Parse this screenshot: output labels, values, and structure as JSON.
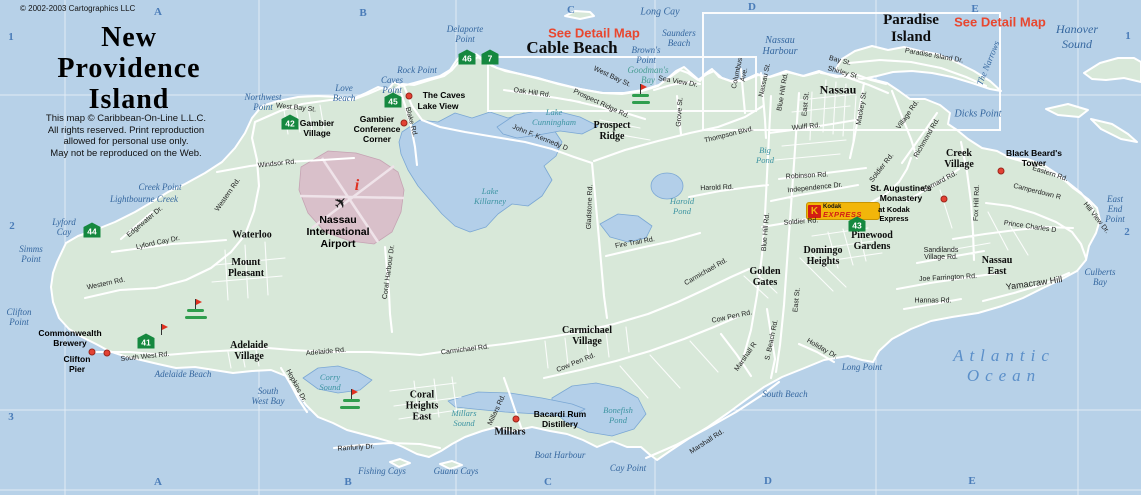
{
  "header": {
    "copyright": "© 2002-2003 Cartographics LLC",
    "title": "New\nProvidence\nIsland",
    "disclaimer": "This map © Caribbean-On-Line L.L.C.\nAll rights reserved. Print reproduction\nallowed for personal use only.\nMay not be reproduced on the Web."
  },
  "colors": {
    "ocean": "#b7d1e8",
    "land": "#d8e8d9",
    "road": "#ffffff",
    "lake": "#b3cfe9",
    "marker_green": "#15883f",
    "poi_dot": "#e34234",
    "detail_red": "#e8472f",
    "airport_pink": "#d9c0ca",
    "grid_blue": "#4a7cb8",
    "golf_green": "#2f9e4e",
    "kodak_yellow": "#f2b60a",
    "kodak_red": "#d21e14"
  },
  "detail_links": [
    {
      "t": "See Detail Map",
      "x": 594,
      "y": 33
    },
    {
      "t": "See Detail Map",
      "x": 1000,
      "y": 22
    }
  ],
  "grid": {
    "cells": [
      {
        "t": "A",
        "x": 158,
        "y": 12
      },
      {
        "t": "B",
        "x": 363,
        "y": 13
      },
      {
        "t": "C",
        "x": 571,
        "y": 10
      },
      {
        "t": "D",
        "x": 752,
        "y": 7
      },
      {
        "t": "E",
        "x": 975,
        "y": 9
      },
      {
        "t": "A",
        "x": 158,
        "y": 482
      },
      {
        "t": "B",
        "x": 348,
        "y": 482
      },
      {
        "t": "C",
        "x": 548,
        "y": 482
      },
      {
        "t": "D",
        "x": 768,
        "y": 481
      },
      {
        "t": "E",
        "x": 972,
        "y": 481
      },
      {
        "t": "1",
        "x": 11,
        "y": 37
      },
      {
        "t": "2",
        "x": 12,
        "y": 226
      },
      {
        "t": "3",
        "x": 11,
        "y": 417
      },
      {
        "t": "1",
        "x": 1128,
        "y": 36
      },
      {
        "t": "2",
        "x": 1127,
        "y": 232
      }
    ]
  },
  "markers": [
    {
      "n": "46",
      "x": 467,
      "y": 57
    },
    {
      "n": "7",
      "x": 490,
      "y": 57
    },
    {
      "n": "45",
      "x": 393,
      "y": 100
    },
    {
      "n": "42",
      "x": 290,
      "y": 122
    },
    {
      "n": "44",
      "x": 92,
      "y": 230
    },
    {
      "n": "41",
      "x": 146,
      "y": 341
    },
    {
      "n": "43",
      "x": 857,
      "y": 224
    }
  ],
  "poi_dots": [
    {
      "x": 409,
      "y": 96
    },
    {
      "x": 404,
      "y": 123
    },
    {
      "x": 92,
      "y": 352
    },
    {
      "x": 107,
      "y": 353
    },
    {
      "x": 516,
      "y": 419
    },
    {
      "x": 944,
      "y": 199
    },
    {
      "x": 1001,
      "y": 171
    }
  ],
  "golf_flags": [
    {
      "x": 641,
      "y": 95,
      "green": true
    },
    {
      "x": 196,
      "y": 310,
      "green": true
    },
    {
      "x": 162,
      "y": 335,
      "green": false
    },
    {
      "x": 352,
      "y": 400,
      "green": true
    }
  ],
  "kodak": {
    "k": "K",
    "brand": "Kodak",
    "express": "EXPRESS"
  },
  "airport_icons": {
    "plane": "✈",
    "info": "i"
  },
  "labels": [
    {
      "t": "Long Cay",
      "x": 660,
      "y": 12,
      "c": "sea",
      "s": 10
    },
    {
      "t": "Hanover Sound",
      "x": 1077,
      "y": 37,
      "c": "sea",
      "s": 12
    },
    {
      "t": "The Narrows",
      "x": 988,
      "y": 63,
      "c": "sea",
      "r": -68
    },
    {
      "t": "Saunders\nBeach",
      "x": 679,
      "y": 38,
      "c": "sea"
    },
    {
      "t": "Brown's\nPoint",
      "x": 646,
      "y": 55,
      "c": "sea"
    },
    {
      "t": "Goodman's\nBay",
      "x": 648,
      "y": 75,
      "c": "sea",
      "col": "#4a9e94"
    },
    {
      "t": "Nassau\nHarbour",
      "x": 780,
      "y": 46,
      "c": "sea",
      "s": 10
    },
    {
      "t": "Delaporte\nPoint",
      "x": 465,
      "y": 34,
      "c": "sea"
    },
    {
      "t": "Rock Point",
      "x": 417,
      "y": 70,
      "c": "sea"
    },
    {
      "t": "Caves\nPoint",
      "x": 392,
      "y": 85,
      "c": "sea"
    },
    {
      "t": "Love\nBeach",
      "x": 344,
      "y": 93,
      "c": "sea"
    },
    {
      "t": "Northwest\nPoint",
      "x": 263,
      "y": 102,
      "c": "sea"
    },
    {
      "t": "Creek Point",
      "x": 160,
      "y": 187,
      "c": "sea"
    },
    {
      "t": "Lightbourne Creek",
      "x": 144,
      "y": 199,
      "c": "sea"
    },
    {
      "t": "Lyford\nCay",
      "x": 64,
      "y": 227,
      "c": "sea"
    },
    {
      "t": "Simms\nPoint",
      "x": 31,
      "y": 254,
      "c": "sea"
    },
    {
      "t": "Clifton\nPoint",
      "x": 19,
      "y": 317,
      "c": "sea"
    },
    {
      "t": "Adelaide Beach",
      "x": 183,
      "y": 374,
      "c": "sea"
    },
    {
      "t": "South\nWest Bay",
      "x": 268,
      "y": 396,
      "c": "sea"
    },
    {
      "t": "Fishing Cays",
      "x": 382,
      "y": 471,
      "c": "sea"
    },
    {
      "t": "Guana Cays",
      "x": 456,
      "y": 471,
      "c": "sea"
    },
    {
      "t": "Boat Harbour",
      "x": 560,
      "y": 455,
      "c": "sea"
    },
    {
      "t": "Cay Point",
      "x": 628,
      "y": 468,
      "c": "sea"
    },
    {
      "t": "South Beach",
      "x": 785,
      "y": 394,
      "c": "sea"
    },
    {
      "t": "Long Point",
      "x": 862,
      "y": 367,
      "c": "sea"
    },
    {
      "t": "Atlantic Ocean",
      "x": 1004,
      "y": 366,
      "c": "sea",
      "s": 17,
      "ls": 6,
      "col": "#5b8fc9"
    },
    {
      "t": "Culberts\nBay",
      "x": 1100,
      "y": 277,
      "c": "sea"
    },
    {
      "t": "East\nEnd\nPoint",
      "x": 1115,
      "y": 209,
      "c": "sea"
    },
    {
      "t": "Dicks Point",
      "x": 978,
      "y": 114,
      "c": "sea",
      "s": 10
    },
    {
      "t": "Lake\nCunningham",
      "x": 554,
      "y": 117,
      "c": "lake"
    },
    {
      "t": "Lake\nKillarney",
      "x": 490,
      "y": 196,
      "c": "lake"
    },
    {
      "t": "Harold\nPond",
      "x": 682,
      "y": 206,
      "c": "lake"
    },
    {
      "t": "Big\nPond",
      "x": 765,
      "y": 155,
      "c": "lake"
    },
    {
      "t": "Bonefish\nPond",
      "x": 618,
      "y": 415,
      "c": "lake"
    },
    {
      "t": "Millars\nSound",
      "x": 464,
      "y": 418,
      "c": "lake"
    },
    {
      "t": "Corry\nSound",
      "x": 330,
      "y": 382,
      "c": "lake"
    },
    {
      "t": "Cable Beach",
      "x": 572,
      "y": 48,
      "c": "town",
      "s": 17
    },
    {
      "t": "Paradise\nIsland",
      "x": 911,
      "y": 29,
      "c": "town",
      "s": 15
    },
    {
      "t": "Nassau",
      "x": 838,
      "y": 90,
      "c": "town",
      "s": 12
    },
    {
      "t": "Prospect\nRidge",
      "x": 612,
      "y": 131,
      "c": "town"
    },
    {
      "t": "Waterloo",
      "x": 252,
      "y": 235,
      "c": "town"
    },
    {
      "t": "Mount\nPleasant",
      "x": 246,
      "y": 268,
      "c": "town"
    },
    {
      "t": "Adelaide\nVillage",
      "x": 249,
      "y": 351,
      "c": "town"
    },
    {
      "t": "Carmichael\nVillage",
      "x": 587,
      "y": 336,
      "c": "town"
    },
    {
      "t": "Coral\nHeights\nEast",
      "x": 422,
      "y": 406,
      "c": "town"
    },
    {
      "t": "Millars",
      "x": 510,
      "y": 432,
      "c": "town"
    },
    {
      "t": "Golden\nGates",
      "x": 765,
      "y": 277,
      "c": "town"
    },
    {
      "t": "Domingo\nHeights",
      "x": 823,
      "y": 256,
      "c": "town"
    },
    {
      "t": "Pinewood\nGardens",
      "x": 872,
      "y": 241,
      "c": "town"
    },
    {
      "t": "Nassau\nEast",
      "x": 997,
      "y": 266,
      "c": "town"
    },
    {
      "t": "Creek\nVillage",
      "x": 959,
      "y": 159,
      "c": "town"
    },
    {
      "t": "The Caves",
      "x": 444,
      "y": 95,
      "c": "poi"
    },
    {
      "t": "Lake View",
      "x": 438,
      "y": 106,
      "c": "poi"
    },
    {
      "t": "Gambier\nVillage",
      "x": 317,
      "y": 128,
      "c": "poi"
    },
    {
      "t": "Gambier\nConference\nCorner",
      "x": 377,
      "y": 129,
      "c": "poi"
    },
    {
      "t": "Nassau\nInternational\nAirport",
      "x": 338,
      "y": 232,
      "c": "poi",
      "s": 10.5
    },
    {
      "t": "Black Beard's\nTower",
      "x": 1034,
      "y": 158,
      "c": "poi"
    },
    {
      "t": "St. Augustine's\nMonastery",
      "x": 901,
      "y": 193,
      "c": "poi"
    },
    {
      "t": "at Kodak\nExpress",
      "x": 894,
      "y": 214,
      "c": "poi",
      "s": 7.5
    },
    {
      "t": "Commonwealth\nBrewery",
      "x": 70,
      "y": 338,
      "c": "poi"
    },
    {
      "t": "Clifton\nPier",
      "x": 77,
      "y": 364,
      "c": "poi"
    },
    {
      "t": "Bacardi Rum\nDistillery",
      "x": 560,
      "y": 419,
      "c": "poi"
    },
    {
      "t": "West Bay St.",
      "x": 612,
      "y": 77,
      "c": "road",
      "r": 25
    },
    {
      "t": "West Bay St.",
      "x": 296,
      "y": 108,
      "c": "road",
      "r": 6
    },
    {
      "t": "Oak Hill Rd.",
      "x": 532,
      "y": 93,
      "c": "road",
      "r": 8
    },
    {
      "t": "Prospect Ridge Rd.",
      "x": 601,
      "y": 104,
      "c": "road",
      "r": 25
    },
    {
      "t": "John F. Kennedy D",
      "x": 540,
      "y": 138,
      "c": "road",
      "r": 22
    },
    {
      "t": "Blake Rd.",
      "x": 411,
      "y": 122,
      "c": "road",
      "r": 75
    },
    {
      "t": "Windsor Rd.",
      "x": 277,
      "y": 164,
      "c": "road",
      "r": -6
    },
    {
      "t": "Western Rd.",
      "x": 228,
      "y": 195,
      "c": "road",
      "r": -55
    },
    {
      "t": "Western Rd.",
      "x": 106,
      "y": 284,
      "c": "road",
      "r": -12
    },
    {
      "t": "Edgewater Dr.",
      "x": 145,
      "y": 222,
      "c": "road",
      "r": -40
    },
    {
      "t": "Lyford Cay Dr.",
      "x": 158,
      "y": 243,
      "c": "road",
      "r": -12
    },
    {
      "t": "South West Rd.",
      "x": 145,
      "y": 357,
      "c": "road",
      "r": -6
    },
    {
      "t": "Adelaide Rd.",
      "x": 326,
      "y": 352,
      "c": "road",
      "r": -5
    },
    {
      "t": "Hopkins Dr.",
      "x": 296,
      "y": 386,
      "c": "road",
      "r": 62
    },
    {
      "t": "Ranfurly Dr.",
      "x": 356,
      "y": 448,
      "c": "road",
      "r": -4
    },
    {
      "t": "Carmichael Rd.",
      "x": 465,
      "y": 350,
      "c": "road",
      "r": -7
    },
    {
      "t": "Carmichael Rd.",
      "x": 706,
      "y": 272,
      "c": "road",
      "r": -30
    },
    {
      "t": "Cow Pen Rd.",
      "x": 576,
      "y": 363,
      "c": "road",
      "r": -22
    },
    {
      "t": "Cow Pen Rd.",
      "x": 732,
      "y": 317,
      "c": "road",
      "r": -12
    },
    {
      "t": "Marshall Rd.",
      "x": 707,
      "y": 442,
      "c": "road",
      "r": -33
    },
    {
      "t": "Marshall R",
      "x": 746,
      "y": 357,
      "c": "road",
      "r": -55
    },
    {
      "t": "S. Beach Rd.",
      "x": 772,
      "y": 340,
      "c": "road",
      "r": -78
    },
    {
      "t": "East St.",
      "x": 797,
      "y": 300,
      "c": "road",
      "r": -84
    },
    {
      "t": "Holiday Dr.",
      "x": 822,
      "y": 349,
      "c": "road",
      "r": 30
    },
    {
      "t": "Millars Rd.",
      "x": 497,
      "y": 410,
      "c": "road",
      "r": -65
    },
    {
      "t": "Fire Trail Rd.",
      "x": 635,
      "y": 243,
      "c": "road",
      "r": -10
    },
    {
      "t": "Gladstone Rd.",
      "x": 590,
      "y": 207,
      "c": "road",
      "r": -88
    },
    {
      "t": "Harold Rd.",
      "x": 717,
      "y": 188,
      "c": "road",
      "r": -2
    },
    {
      "t": "Thompson Blvd.",
      "x": 729,
      "y": 135,
      "c": "road",
      "r": -14
    },
    {
      "t": "Robinson Rd.",
      "x": 807,
      "y": 176,
      "c": "road",
      "r": -3
    },
    {
      "t": "Independence Dr.",
      "x": 815,
      "y": 188,
      "c": "road",
      "r": -6
    },
    {
      "t": "Soldier Rd.",
      "x": 801,
      "y": 222,
      "c": "road",
      "r": -4
    },
    {
      "t": "Soldier Rd.",
      "x": 882,
      "y": 168,
      "c": "road",
      "r": -52
    },
    {
      "t": "Blue Hill Rd.",
      "x": 766,
      "y": 232,
      "c": "road",
      "r": -85
    },
    {
      "t": "Blue Hill Rd.",
      "x": 783,
      "y": 92,
      "c": "road",
      "r": -80
    },
    {
      "t": "East St.",
      "x": 806,
      "y": 104,
      "c": "road",
      "r": -84
    },
    {
      "t": "Nassau St.",
      "x": 765,
      "y": 80,
      "c": "road",
      "r": -78
    },
    {
      "t": "Columbus\nAve.",
      "x": 741,
      "y": 74,
      "c": "road",
      "r": -78
    },
    {
      "t": "Wulff Rd.",
      "x": 806,
      "y": 127,
      "c": "road",
      "r": -6
    },
    {
      "t": "Mackey St.",
      "x": 862,
      "y": 108,
      "c": "road",
      "r": -80
    },
    {
      "t": "Shirley St.",
      "x": 843,
      "y": 73,
      "c": "road",
      "r": 16
    },
    {
      "t": "Bay St.",
      "x": 840,
      "y": 61,
      "c": "road",
      "r": 14
    },
    {
      "t": "Sea View Dr.",
      "x": 678,
      "y": 82,
      "c": "road",
      "r": 10
    },
    {
      "t": "Grove St.",
      "x": 680,
      "y": 112,
      "c": "road",
      "r": -86
    },
    {
      "t": "Village Rd.",
      "x": 908,
      "y": 115,
      "c": "road",
      "r": -55
    },
    {
      "t": "Richmond Rd.",
      "x": 927,
      "y": 138,
      "c": "road",
      "r": -60
    },
    {
      "t": "Bernard Rd.",
      "x": 940,
      "y": 182,
      "c": "road",
      "r": -28
    },
    {
      "t": "Fox Hill Rd.",
      "x": 977,
      "y": 203,
      "c": "road",
      "r": -88
    },
    {
      "t": "Eastern Rd.",
      "x": 1050,
      "y": 174,
      "c": "road",
      "r": 18
    },
    {
      "t": "Camperdown R",
      "x": 1037,
      "y": 192,
      "c": "road",
      "r": 14
    },
    {
      "t": "Hill View Dr.",
      "x": 1096,
      "y": 218,
      "c": "road",
      "r": 52
    },
    {
      "t": "Prince Charles D",
      "x": 1030,
      "y": 227,
      "c": "road",
      "r": 8
    },
    {
      "t": "Paradise Island Dr.",
      "x": 934,
      "y": 56,
      "c": "road",
      "r": 10
    },
    {
      "t": "Joe Farrington Rd.",
      "x": 948,
      "y": 278,
      "c": "road",
      "r": -3
    },
    {
      "t": "Sandilands\nVillage Rd.",
      "x": 941,
      "y": 254,
      "c": "road"
    },
    {
      "t": "Hannas Rd.",
      "x": 933,
      "y": 301,
      "c": "road"
    },
    {
      "t": "Yamacraw Hill",
      "x": 1034,
      "y": 283,
      "c": "road",
      "s": 9,
      "r": -8
    },
    {
      "t": "Coral Harbour Dr.",
      "x": 389,
      "y": 272,
      "c": "road",
      "r": -82
    }
  ]
}
